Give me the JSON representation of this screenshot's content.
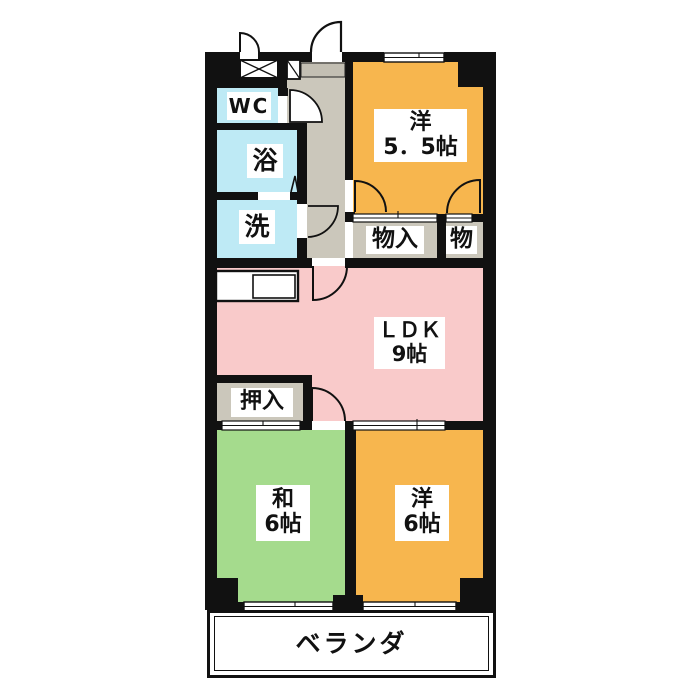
{
  "image_type": "apartment floor plan",
  "rooms": {
    "wc": {
      "label": "WC"
    },
    "bath": {
      "label": "浴"
    },
    "wash": {
      "label": "洗"
    },
    "western55": {
      "name": "洋",
      "size": "5．5帖"
    },
    "storage_in": {
      "label": "物入"
    },
    "storage": {
      "label": "物"
    },
    "ldk": {
      "name": "ＬＤＫ",
      "size": "9帖"
    },
    "oshiire": {
      "label": "押入"
    },
    "japanese6": {
      "name": "和",
      "size": "6帖"
    },
    "western6": {
      "name": "洋",
      "size": "6帖"
    },
    "veranda": {
      "label": "ベランダ"
    }
  },
  "colors": {
    "wall": "#111111",
    "western_room_fill": "#F7B64E",
    "ldk_fill": "#F9CACA",
    "japanese_room_fill": "#A5DB8D",
    "wet_area_fill": "#BEEAF5",
    "hall_and_closet_fill": "#CBC7BB",
    "label_background": "#FFFFFF",
    "background": "#FFFFFF"
  }
}
